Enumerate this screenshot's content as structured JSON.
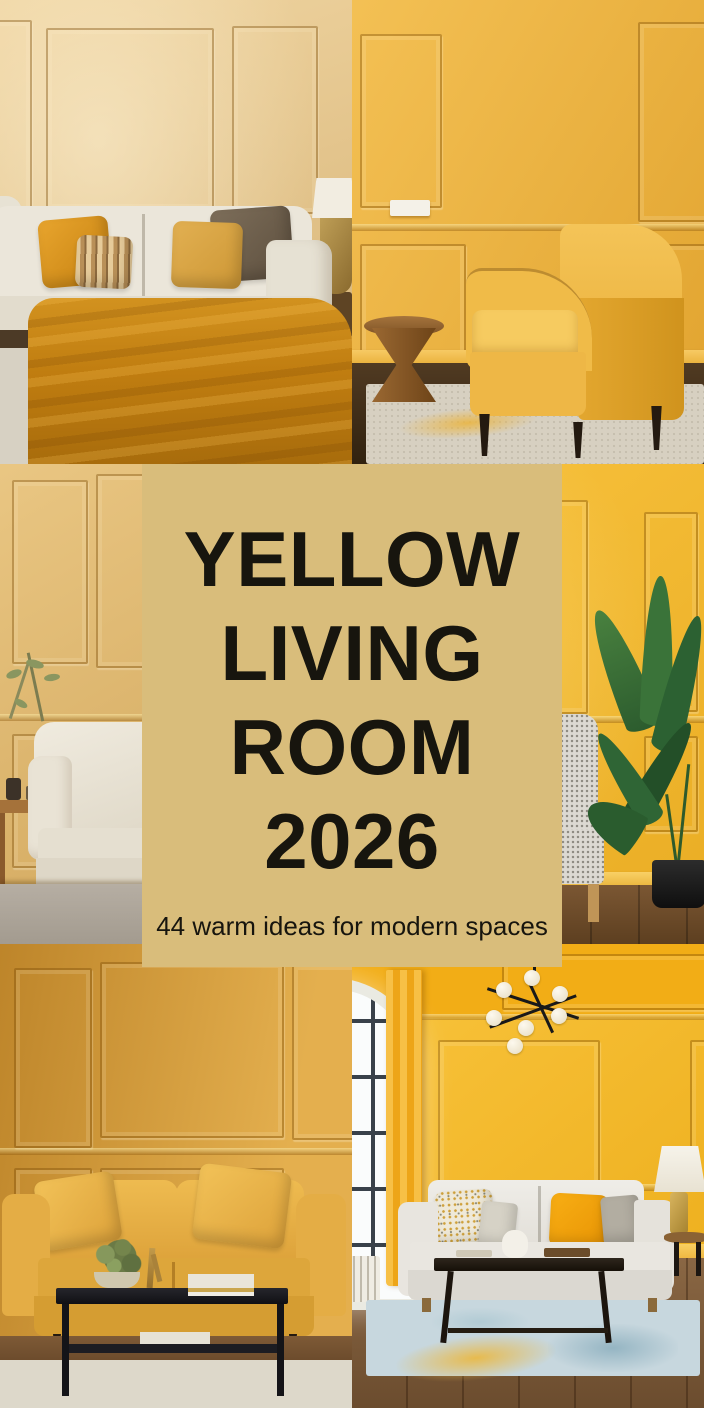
{
  "card": {
    "title_lines": [
      "YELLOW",
      "LIVING",
      "ROOM",
      "2026"
    ],
    "subtitle": "44 warm ideas for modern spaces",
    "background": "#d9bd7b",
    "text_color": "#17150e"
  },
  "photos": [
    {
      "position": "top-left",
      "wall_color": "#e9c98e",
      "description": "Cream sofa bed with mustard throw blanket and gold, striped, linen and brown cushions against a warm beige panelled wall with a brass table lamp"
    },
    {
      "position": "top-right",
      "wall_color": "#efb137",
      "description": "Mustard yellow velvet armchair with black tapered legs next to a turned wooden side table on a beige rug against a golden panelled wall"
    },
    {
      "position": "middle-left",
      "wall_color": "#e1b668",
      "description": "Cream fabric armchair beside a wooden side table with green sprigs against a honey gold panelled wall on grey carpet"
    },
    {
      "position": "middle-right",
      "wall_color": "#f7bb2a",
      "description": "Grey patterned armchair with a yellow cushion and a tall bird of paradise plant in a black pot against a vivid yellow panelled wall"
    },
    {
      "position": "bottom-left",
      "wall_color": "#dca13a",
      "description": "Mustard yellow sofa with matching cushions behind a black metal coffee table styled with greenery, a brass object and books on a pale rug"
    },
    {
      "position": "bottom-right",
      "wall_color": "#f6b71c",
      "description": "White sofa with speckled gold and orange cushions, black coffee table, pale blue abstract rug, arched window with yellow curtain and a black globe chandelier in a bright yellow room"
    }
  ]
}
